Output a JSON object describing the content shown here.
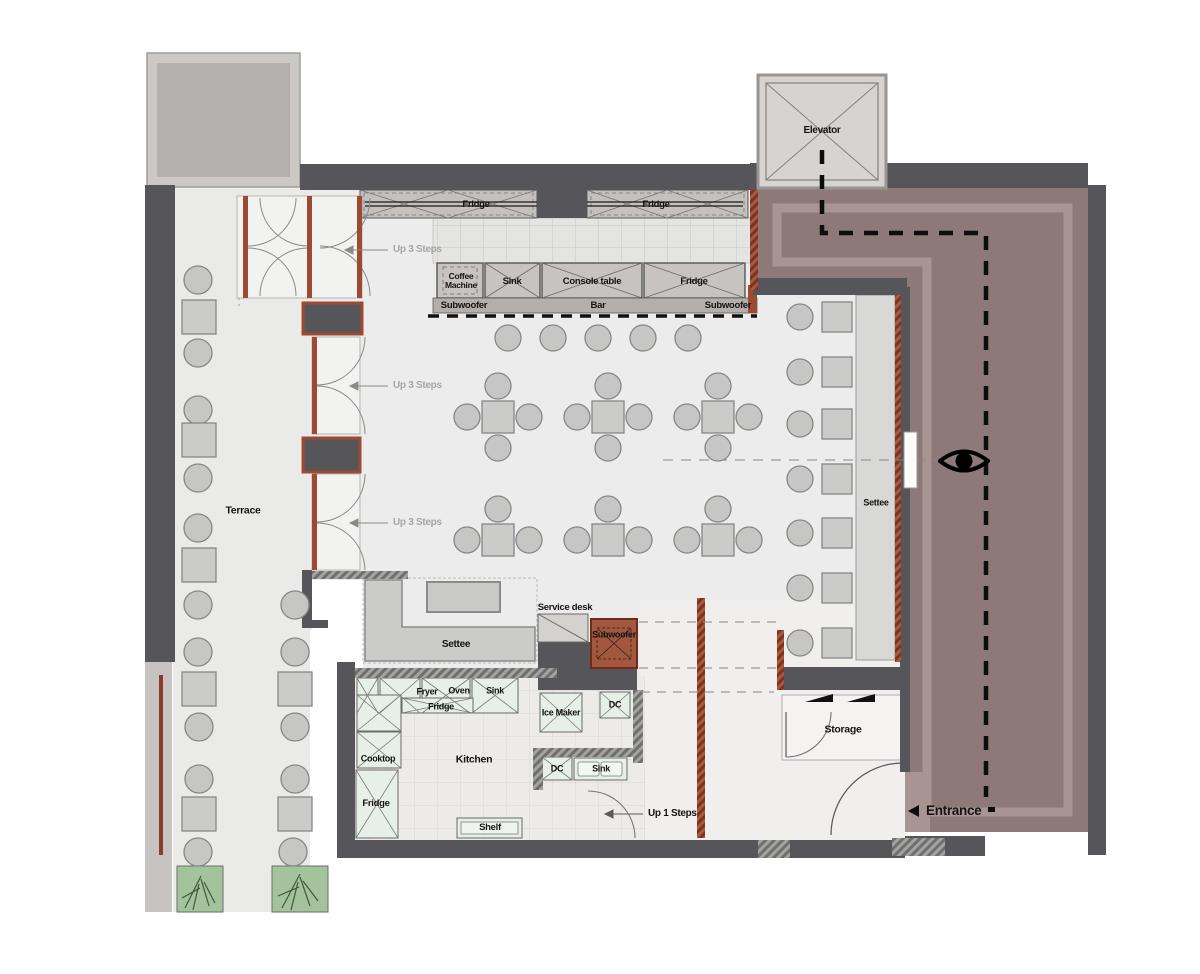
{
  "plan_title": "Cafe floor plan",
  "colors": {
    "wall": "#56565a",
    "floor": "#ececec",
    "terrace_floor": "#eaeae8",
    "hall_floor": "#f0efed",
    "corridor": "#8d7a78",
    "corridor_band": "#a89593",
    "roof_outer": "#cbc8c5",
    "roof_inner": "#b4b1ae",
    "elevator_fill": "#d6d3d0",
    "furniture_fill": "#c6c6c4",
    "table_fill": "#cbcbc9",
    "furniture_stroke": "#87878a",
    "settee_fill": "#d8d8d6",
    "bar_counter": "#c6c3c0",
    "appliance_fill": "#e7efe9",
    "door_frame": "#9e4a32",
    "subwoofer_fill": "#a3573f",
    "planter_green": "#a2c39c",
    "path_color": "#0d0d0d"
  },
  "labels": [
    {
      "name": "label-fridge-band-left",
      "text": "Fridge",
      "x": 476,
      "y": 205,
      "size": 9.5
    },
    {
      "name": "label-fridge-band-right",
      "text": "Fridge",
      "x": 656,
      "y": 205,
      "size": 9.5
    },
    {
      "name": "label-up-3-steps-1",
      "text": "Up 3 Steps",
      "x": 393,
      "y": 250,
      "size": 10,
      "color": "#a6a6a4",
      "anchor": "left"
    },
    {
      "name": "label-up-3-steps-2",
      "text": "Up 3 Steps",
      "x": 393,
      "y": 386,
      "size": 10,
      "color": "#a6a6a4",
      "anchor": "left"
    },
    {
      "name": "label-up-3-steps-3",
      "text": "Up 3 Steps",
      "x": 393,
      "y": 523,
      "size": 10,
      "color": "#a6a6a4",
      "anchor": "left"
    },
    {
      "name": "label-coffee-machine",
      "text": "Coffee Machine",
      "x": 461,
      "y": 281,
      "size": 8.5,
      "width": 46
    },
    {
      "name": "label-bar-sink",
      "text": "Sink",
      "x": 512,
      "y": 282,
      "size": 9.5
    },
    {
      "name": "label-console-table",
      "text": "Console table",
      "x": 592,
      "y": 282,
      "size": 9.5
    },
    {
      "name": "label-bar-fridge",
      "text": "Fridge",
      "x": 694,
      "y": 282,
      "size": 9.5
    },
    {
      "name": "label-subwoofer-left",
      "text": "Subwoofer",
      "x": 464,
      "y": 306,
      "size": 9.5
    },
    {
      "name": "label-bar",
      "text": "Bar",
      "x": 598,
      "y": 306,
      "size": 9.5
    },
    {
      "name": "label-subwoofer-right",
      "text": "Subwoofer",
      "x": 728,
      "y": 306,
      "size": 9.5
    },
    {
      "name": "label-elevator",
      "text": "Elevator",
      "x": 822,
      "y": 131,
      "size": 10
    },
    {
      "name": "label-terrace",
      "text": "Terrace",
      "x": 243,
      "y": 511,
      "size": 10.5
    },
    {
      "name": "label-settee-right",
      "text": "Settee",
      "x": 876,
      "y": 503,
      "size": 9
    },
    {
      "name": "label-settee-left",
      "text": "Settee",
      "x": 456,
      "y": 645,
      "size": 10
    },
    {
      "name": "label-service-desk",
      "text": "Service desk",
      "x": 565,
      "y": 608,
      "size": 9.5
    },
    {
      "name": "label-subwoofer-mid",
      "text": "Subwoofer",
      "x": 614,
      "y": 635,
      "size": 9
    },
    {
      "name": "label-storage",
      "text": "Storage",
      "x": 843,
      "y": 730,
      "size": 10.5
    },
    {
      "name": "label-entrance",
      "text": "Entrance",
      "x": 926,
      "y": 811,
      "size": 13.5,
      "anchor": "left"
    },
    {
      "name": "label-kitchen",
      "text": "Kitchen",
      "x": 474,
      "y": 760,
      "size": 10.5
    },
    {
      "name": "label-fryer",
      "text": "Fryer",
      "x": 427,
      "y": 692,
      "size": 9
    },
    {
      "name": "label-oven",
      "text": "Oven",
      "x": 459,
      "y": 691,
      "size": 9
    },
    {
      "name": "label-kitchen-sink-top",
      "text": "Sink",
      "x": 495,
      "y": 691,
      "size": 9
    },
    {
      "name": "label-kitchen-fridge-top",
      "text": "Fridge",
      "x": 441,
      "y": 707,
      "size": 9
    },
    {
      "name": "label-ice-maker",
      "text": "Ice Maker",
      "x": 561,
      "y": 713,
      "size": 9
    },
    {
      "name": "label-dc-top",
      "text": "DC",
      "x": 615,
      "y": 705,
      "size": 9
    },
    {
      "name": "label-cooktop",
      "text": "Cooktop",
      "x": 378,
      "y": 759,
      "size": 9
    },
    {
      "name": "label-dc-mid",
      "text": "DC",
      "x": 557,
      "y": 769,
      "size": 9
    },
    {
      "name": "label-sink-mid",
      "text": "Sink",
      "x": 601,
      "y": 769,
      "size": 9
    },
    {
      "name": "label-kitchen-fridge-left",
      "text": "Fridge",
      "x": 376,
      "y": 804,
      "size": 9.5
    },
    {
      "name": "label-shelf",
      "text": "Shelf",
      "x": 490,
      "y": 828,
      "size": 9.5
    },
    {
      "name": "label-up-1-steps",
      "text": "Up 1 Steps",
      "x": 648,
      "y": 814,
      "size": 10,
      "anchor": "left"
    }
  ],
  "furniture": {
    "terrace_chairs": [
      [
        198,
        280
      ],
      [
        198,
        353
      ],
      [
        198,
        410
      ],
      [
        198,
        478
      ],
      [
        198,
        528
      ],
      [
        198,
        605
      ],
      [
        198,
        652
      ],
      [
        199,
        727
      ],
      [
        199,
        779
      ],
      [
        198,
        852
      ],
      [
        295,
        605
      ],
      [
        295,
        652
      ],
      [
        295,
        727
      ],
      [
        295,
        779
      ],
      [
        293,
        852
      ]
    ],
    "terrace_tables": [
      [
        182,
        300
      ],
      [
        182,
        423
      ],
      [
        182,
        548
      ],
      [
        182,
        672
      ],
      [
        182,
        797
      ],
      [
        278,
        672
      ],
      [
        278,
        797
      ]
    ],
    "bar_stools": {
      "y": 338,
      "xs": [
        508,
        553,
        598,
        643,
        688
      ],
      "r": 13
    },
    "dining_sets": [
      {
        "cx": 498,
        "cy": 417,
        "chairs": 4
      },
      {
        "cx": 608,
        "cy": 417,
        "chairs": 4
      },
      {
        "cx": 718,
        "cy": 417,
        "chairs": 4
      },
      {
        "cx": 498,
        "cy": 540,
        "chairs": 3
      },
      {
        "cx": 608,
        "cy": 540,
        "chairs": 3
      },
      {
        "cx": 718,
        "cy": 540,
        "chairs": 3
      }
    ],
    "settee_pairs_y": [
      317,
      372,
      424,
      479,
      533,
      588,
      643
    ]
  }
}
